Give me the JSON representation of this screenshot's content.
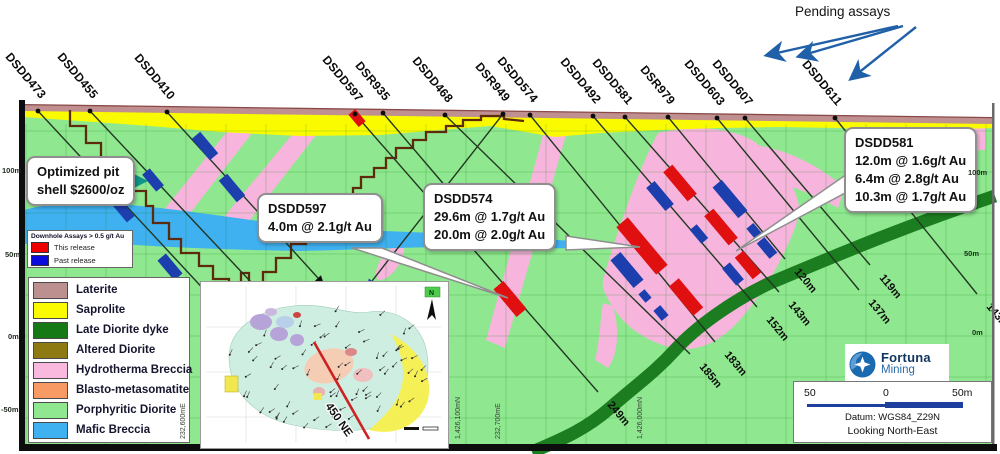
{
  "pending": {
    "label": "Pending assays"
  },
  "section": {
    "drillholes": [
      {
        "id": "DSDD473",
        "collar": [
          38,
          111
        ],
        "end": [
          262,
          352
        ]
      },
      {
        "id": "DSDD455",
        "collar": [
          90,
          111
        ],
        "end": [
          298,
          332
        ]
      },
      {
        "id": "DSDD410",
        "collar": [
          167,
          112
        ],
        "end": [
          318,
          278
        ],
        "end_arrow": "black"
      },
      {
        "id": "DSDD597",
        "collar": [
          355,
          114
        ],
        "end": [
          598,
          392
        ],
        "eoh": "249m"
      },
      {
        "id": "DSR935",
        "collar": [
          383,
          113
        ],
        "end": [
          470,
          215
        ]
      },
      {
        "id": "DSDD468",
        "collar": [
          445,
          115
        ],
        "end": [
          690,
          354
        ],
        "eoh": "185m"
      },
      {
        "id": "DSR949",
        "collar": [
          503,
          114
        ],
        "end": [
          372,
          281
        ],
        "end_arrow": "blue"
      },
      {
        "id": "DSDD574",
        "collar": [
          530,
          115
        ],
        "end": [
          715,
          342
        ],
        "eoh": "183m"
      },
      {
        "id": "DSDD492",
        "collar": [
          593,
          116
        ],
        "end": [
          757,
          307
        ],
        "eoh": "152m"
      },
      {
        "id": "DSDD581",
        "collar": [
          625,
          117
        ],
        "end": [
          779,
          292
        ],
        "eoh": "143m"
      },
      {
        "id": "DSR979",
        "collar": [
          668,
          117
        ],
        "end": [
          785,
          259
        ],
        "eoh": "120m"
      },
      {
        "id": "DSDD603",
        "collar": [
          717,
          118
        ],
        "end": [
          859,
          290
        ],
        "eoh": "137m"
      },
      {
        "id": "DSDD607",
        "collar": [
          745,
          118
        ],
        "end": [
          870,
          265
        ],
        "eoh": "119m"
      },
      {
        "id": "DSDD611",
        "collar": [
          835,
          118
        ],
        "end": [
          977,
          294
        ],
        "eoh": "143m"
      }
    ],
    "intercepts_red": [
      [
        357,
        118,
        16,
        9
      ],
      [
        510,
        299,
        36,
        13
      ],
      [
        642,
        246,
        62,
        15
      ],
      [
        686,
        297,
        38,
        13
      ],
      [
        680,
        183,
        38,
        12
      ],
      [
        721,
        227,
        38,
        12
      ],
      [
        748,
        265,
        28,
        11
      ]
    ],
    "intercepts_blue": [
      [
        205,
        146,
        28,
        11
      ],
      [
        153,
        180,
        22,
        10
      ],
      [
        232,
        188,
        28,
        11
      ],
      [
        123,
        210,
        24,
        10
      ],
      [
        170,
        267,
        26,
        11
      ],
      [
        660,
        196,
        30,
        11
      ],
      [
        730,
        199,
        40,
        12
      ],
      [
        627,
        270,
        36,
        13
      ],
      [
        645,
        296,
        11,
        8
      ],
      [
        661,
        313,
        13,
        9
      ],
      [
        699,
        234,
        18,
        9
      ],
      [
        733,
        274,
        22,
        10
      ],
      [
        755,
        232,
        16,
        9
      ],
      [
        767,
        248,
        20,
        10
      ]
    ],
    "edge_labels_left": [
      {
        "text": "100m",
        "x": 2,
        "y": 166
      },
      {
        "text": "50m",
        "x": 5,
        "y": 250
      },
      {
        "text": "0m",
        "x": 8,
        "y": 332
      },
      {
        "text": "-50m",
        "x": 1,
        "y": 405
      }
    ],
    "edge_labels_right": [
      {
        "text": "100m",
        "x": 968,
        "y": 168
      },
      {
        "text": "50m",
        "x": 964,
        "y": 249
      },
      {
        "text": "0m",
        "x": 972,
        "y": 328
      }
    ],
    "coord_labels": [
      {
        "text": "232,600mE",
        "x": 187
      },
      {
        "text": "1,426,100mN",
        "x": 462
      },
      {
        "text": "232,700mE",
        "x": 502
      },
      {
        "text": "1,426,000mN",
        "x": 644
      }
    ]
  },
  "callouts": [
    {
      "key": "pit",
      "x": 26,
      "y": 156,
      "lines": [
        "Optimized pit",
        "shell $2600/oz"
      ]
    },
    {
      "key": "dsdd597",
      "x": 257,
      "y": 193,
      "lines": [
        "DSDD597",
        "4.0m @ 2.1g/t Au"
      ]
    },
    {
      "key": "dsdd574",
      "x": 423,
      "y": 183,
      "lines": [
        "DSDD574",
        "29.6m @ 1.7g/t Au",
        "20.0m @ 2.0g/t Au"
      ]
    },
    {
      "key": "dsdd581",
      "x": 844,
      "y": 127,
      "lines": [
        "DSDD581",
        "12.0m @ 1.6g/t Au",
        "6.4m @ 2.8g/t Au",
        "10.3m @ 1.7g/t Au"
      ]
    }
  ],
  "assay_legend": {
    "title": "Downhole Assays > 0.5 g/t Au",
    "items": [
      {
        "label": "This release",
        "color": "#ee0000"
      },
      {
        "label": "Past release",
        "color": "#0b0bdd"
      }
    ]
  },
  "geology_legend": [
    {
      "label": "Laterite",
      "color": "#bd9090"
    },
    {
      "label": "Saprolite",
      "color": "#fbfb00"
    },
    {
      "label": "Late Diorite dyke",
      "color": "#157a15"
    },
    {
      "label": "Altered Diorite",
      "color": "#8d7a12"
    },
    {
      "label": "Hydrotherma Breccia",
      "color": "#f9b8de"
    },
    {
      "label": "Blasto-metasomatite",
      "color": "#f89a63"
    },
    {
      "label": "Porphyritic Diorite",
      "color": "#8fe88f"
    },
    {
      "label": "Mafic Breccia",
      "color": "#3fb0f0"
    }
  ],
  "logo": {
    "name": "Fortuna",
    "sub": "Mining"
  },
  "scalebar": {
    "left": "50",
    "mid": "0",
    "right": "50m",
    "datum": "Datum: WGS84_Z29N",
    "looking": "Looking North-East"
  },
  "inset": {
    "section_label": "450 NE",
    "north": "N"
  },
  "colors": {
    "section_green": "#8fe88f",
    "saprolite": "#fbfb00",
    "laterite": "#c09090",
    "surface_line": "#8a4848",
    "pink_breccia": "#f7b4dc",
    "mafic_blue": "#3fb0f0",
    "dyke_green": "#1b7d1f",
    "pit_line": "#5e2a0c",
    "red_assay": "#e01010",
    "blue_assay": "#1d3fae",
    "arrow_blue": "#2060a8",
    "pit_arrow_teal": "#0e9488"
  }
}
